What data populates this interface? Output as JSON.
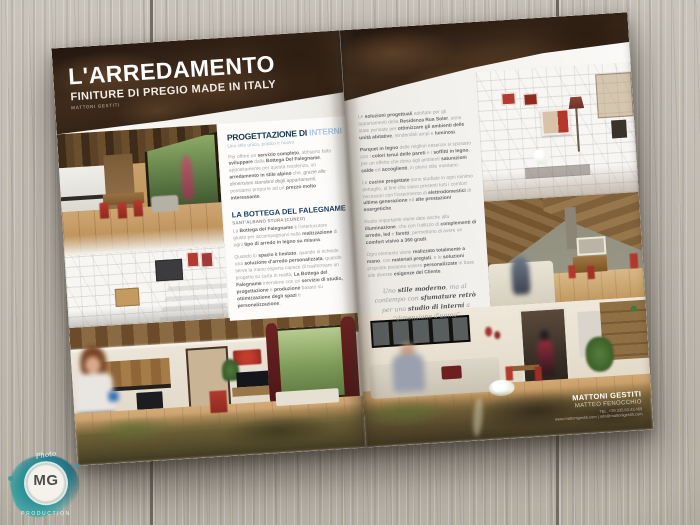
{
  "logo": {
    "script": "Photo",
    "initials": "MG",
    "caption": "PRODUCTION"
  },
  "left_page": {
    "header": {
      "title": "L'ARREDAMENTO",
      "subtitle": "FINITURE DI PREGIO MADE IN ITALY",
      "brand": "MATTONI GESTITI"
    },
    "interni": {
      "heading_dark": "PROGETTAZIONE DI",
      "heading_light": " INTERNI",
      "tagline": "Uno stile unico, pratico e nuovo",
      "body": "Per offrire un **servizio completo**, abbiamo fatto **sviluppare** dalla **Bottega Del Falegname**, appositamente per questa residenza, un **arredamento in stile alpino** che, *grazie alle dimensioni standard degli appartamenti*, possiamo proporre ad un **prezzo molto interessante**."
    },
    "bottega": {
      "heading": "LA BOTTEGA DEL FALEGNAME",
      "subheading": "SANT'ALBANO STURA (CUNEO)",
      "body1": "La **Bottega del Falegname** è l'interlocutore giusto per accompagnarvi nella **realizzazione** di ogni **tipo di arredo in legno su misura**.",
      "body2": "Quando lo **spazio è limitato**, quando si richiede una **soluzione d'arredo personalizzata**, quando serve la mano esperta capace di trasformare un progetto su carta in realtà, **La Bottega del Falegname** interviene con un **servizio di studio, progettazione** e **produzione** basato su **ottimizzazione degli spazi** e **personalizzazione**."
    }
  },
  "right_page": {
    "paragraphs": [
      "Le **soluzioni progettuali** adottate per gli appartamenti della **Residenza Rua Soler**, sono state pensate per **ottimizzare gli ambienti delle unità abitative**, rendendoli ampi e **luminosi**.",
      "**Parquet in legno** delle migliori essenze si sposano con i **colori tenui delle pareti** e i **soffitti in legno**, per un effetto che dona agli ambienti **saturazioni calde** ed **accoglienti**, in pieno stile montano.",
      "Le **cucine progettate** sono studiate in ogni minimo dettaglio, al fine che siano presenti tutti i comfort necessari con l'inserimento di **elettrodomestici** di **ultima generazione** ed **alte prestazioni energetiche**.",
      "Ruolo importante viene dato anche alla **illuminazione**, che con l'utilizzo di **complementi di arredo, led** e **faretti**, permettono di avere un **comfort visivo a 360 gradi**.",
      "Ogni elemento viene **realizzato totalmente a mano**, con **materiali pregiati**, e le **soluzioni** proposte possono essere **personalizzate** in base alle diverse **esigenze del Cliente**."
    ],
    "quote": "Uno **stile moderno**, ma al contempo con **sfumature retrò** per uno **studio di interni** a *“dimensione d'uomo”*",
    "contact": {
      "company": "MATTONI GESTITI",
      "name": "MATTEO FENOCCHIO",
      "phone": "TEL. +39 335.63.43.469",
      "web": "www.mattonigestiti.com | info@mattonigestiti.com"
    }
  }
}
